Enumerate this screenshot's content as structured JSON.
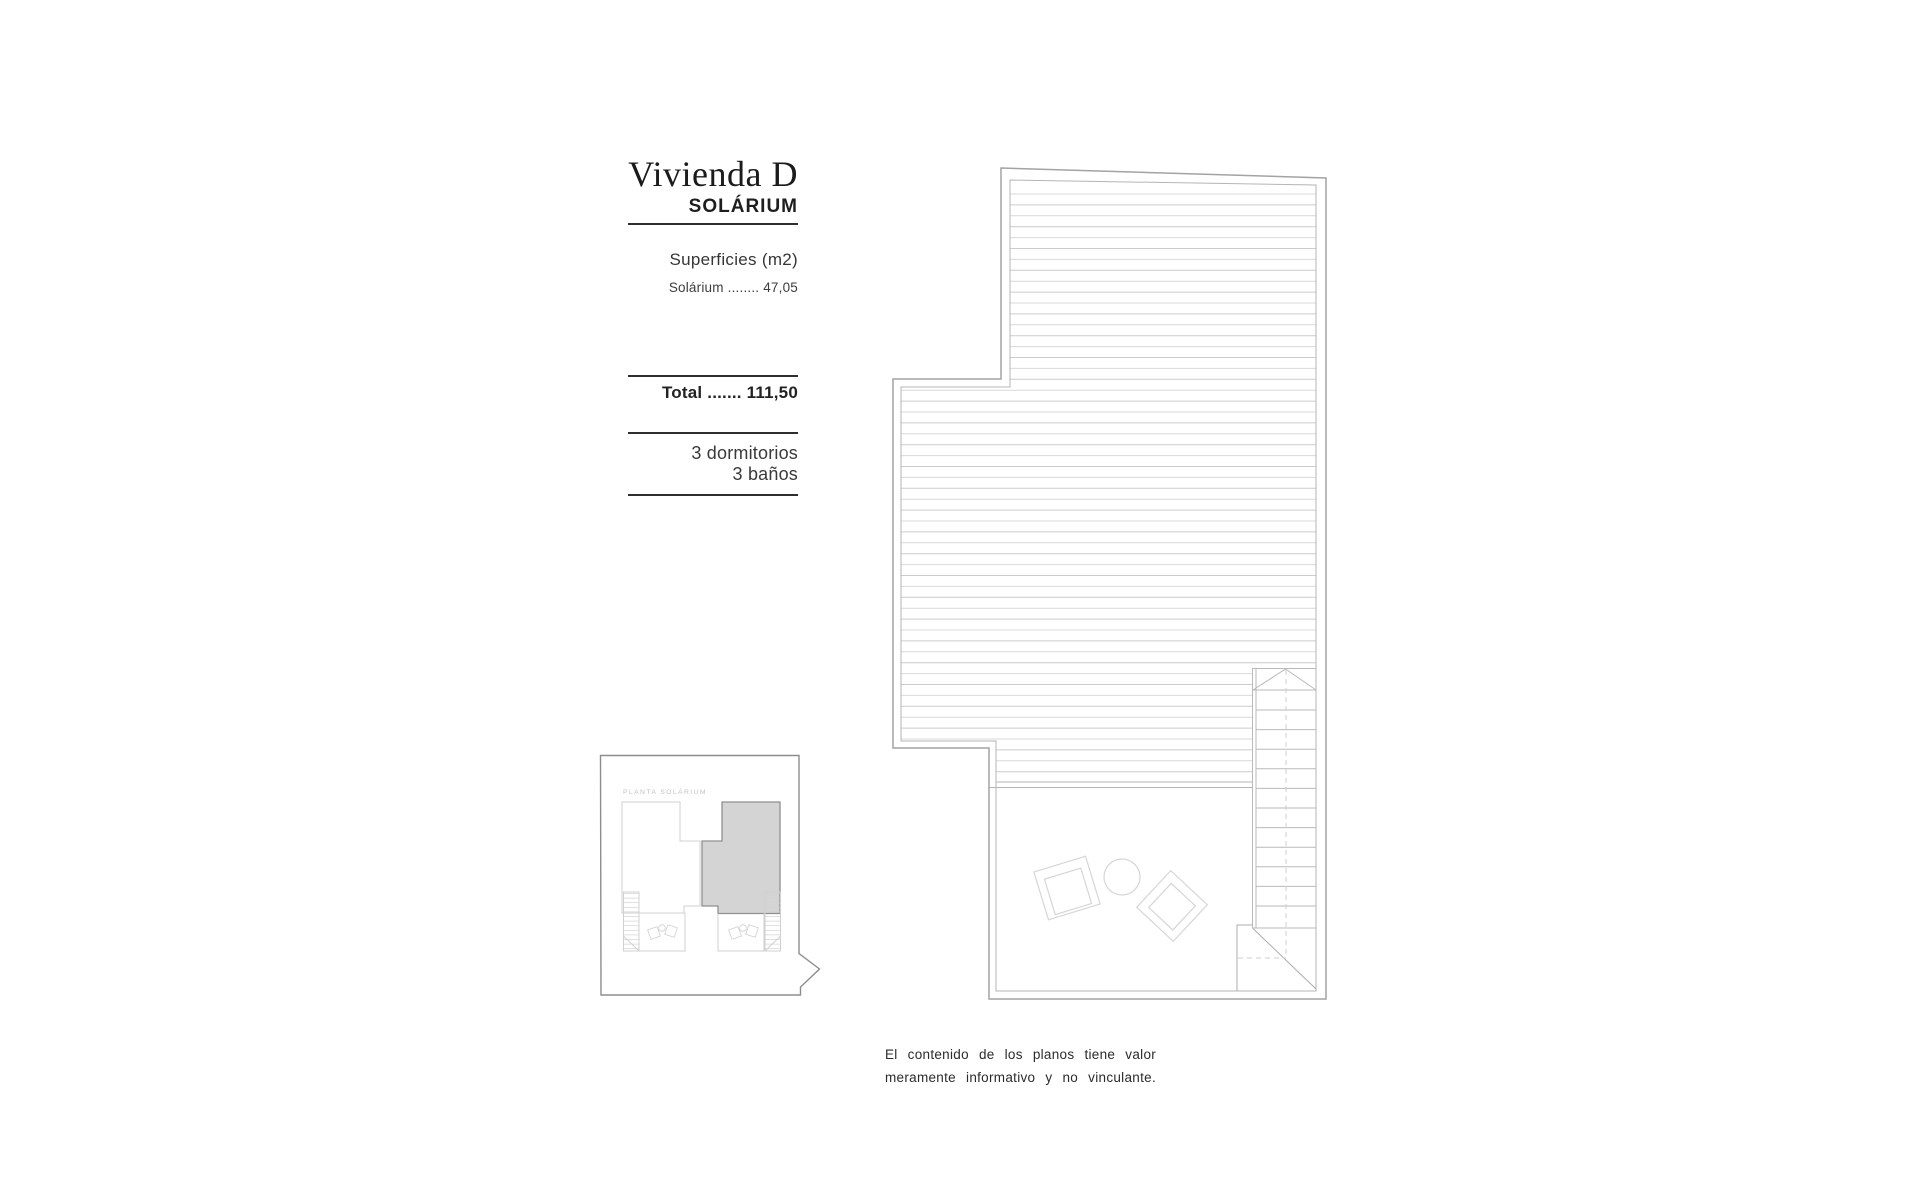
{
  "info_panel": {
    "title": "Vivienda D",
    "subtitle": "SOLÁRIUM",
    "surfaces_heading": "Superficies (m2)",
    "surface_rows": [
      {
        "label": "Solárium",
        "dots": "........",
        "value": "47,05"
      }
    ],
    "total": {
      "label": "Total",
      "dots": ".......",
      "value": "111,50"
    },
    "features": [
      "3 dormitorios",
      "3 baños"
    ]
  },
  "key_plan": {
    "label": "PLANTA SOLÁRIUM"
  },
  "disclaimer": {
    "line1": "El contenido de los planos tiene valor",
    "line2": "meramente informativo y no vinculante."
  },
  "colors": {
    "page_bg": "#ffffff",
    "text": "#1c1c1c",
    "rule": "#2e2e2e",
    "plan_wall_outer": "#a3a3a3",
    "plan_wall_inner": "#b5b5b5",
    "deck_hatch_a": "#d9d9d9",
    "deck_hatch_b": "#cccccc",
    "stair_line": "#b9b9b9",
    "dashed_line": "#cfcfcf",
    "furniture_line": "#d6d6d6",
    "keyplan_border": "#8d8d8d",
    "keyplan_faint": "#d0d0d0",
    "keyplan_highlight_fill": "#d4d4d4",
    "keyplan_highlight_border": "#8f8f8f"
  }
}
